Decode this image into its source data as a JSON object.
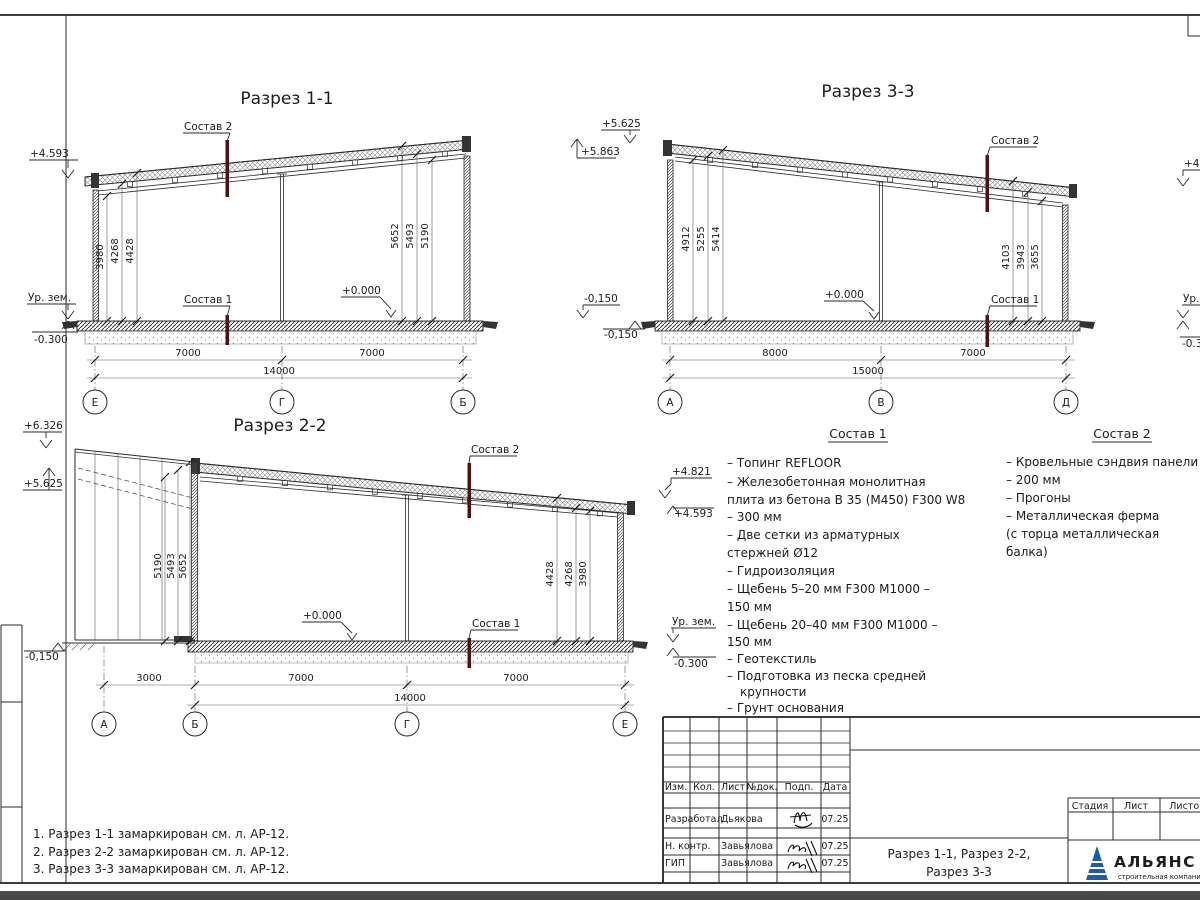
{
  "sheet": {
    "notes": [
      "1. Разрез 1-1 замаркирован см. л. АР-12.",
      "2. Разрез 2-2 замаркирован см. л. АР-12.",
      "3. Разрез 3-3 замаркирован см. л. АР-12."
    ]
  },
  "sections": {
    "s11": {
      "title": "Разрез 1-1",
      "sostav2_label": "Состав 2",
      "sostav1_label": "Состав 1",
      "elev_left_top": "+4.593",
      "ground_label": "Ур. зем.",
      "elev_left_bottom": "-0.300",
      "elev_right_top": "+5.863",
      "elev_right_bottom": "-0,150",
      "floor_mark": "+0.000",
      "dims_left": [
        "3980",
        "4268",
        "4428"
      ],
      "dims_right": [
        "5652",
        "5493",
        "5190"
      ],
      "span_dims": [
        "7000",
        "7000"
      ],
      "total_dim": "14000",
      "axes": [
        "Е",
        "Г",
        "Б"
      ]
    },
    "s33": {
      "title": "Разрез 3-3",
      "sostav2_label": "Состав 2",
      "sostav1_label": "Состав 1",
      "elev_left_top": "+5.625",
      "elev_left_bottom": "-0,150",
      "elev_right_top": "+4.29",
      "ground_label": "Ур. зем.",
      "elev_right_bottom": "-0.300",
      "floor_mark": "+0.000",
      "dims_left": [
        "4912",
        "5255",
        "5414"
      ],
      "dims_right": [
        "4103",
        "3943",
        "3655"
      ],
      "span_dims": [
        "8000",
        "7000"
      ],
      "total_dim": "15000",
      "axes": [
        "А",
        "В",
        "Д"
      ]
    },
    "s22": {
      "title": "Разрез 2-2",
      "sostav2_label": "Состав 2",
      "sostav1_label": "Состав 1",
      "elev_left_top": "+6.326",
      "elev_left_mid": "+5.625",
      "elev_left_bottom": "-0,150",
      "elev_right_top": "+4.821",
      "elev_right_mid": "+4.593",
      "ground_label": "Ур. зем.",
      "elev_right_bottom": "-0.300",
      "floor_mark": "+0.000",
      "dims_left": [
        "5190",
        "5493",
        "5652"
      ],
      "dims_right": [
        "4428",
        "4268",
        "3980"
      ],
      "span_dims": [
        "3000",
        "7000",
        "7000"
      ],
      "total_dim": "14000",
      "axes": [
        "А",
        "Б",
        "Г",
        "Е"
      ]
    }
  },
  "sostav1": {
    "title": "Состав 1",
    "items": [
      "– Топинг REFLOOR",
      "– Железобетонная  монолитная",
      "плита из бетона В 35 (М450) F300 W8",
      "– 300 мм",
      "– Две сетки из арматурных",
      "стержней Ø12",
      "– Гидроизоляция",
      "– Щебень 5–20 мм F300 М1000    –",
      "150 мм",
      "– Щебень 20–40 мм F300 М1000   –",
      "150 мм",
      "– Геотекстиль",
      "– Подготовка из песка средней",
      "крупности",
      "– Грунт основания"
    ]
  },
  "sostav2": {
    "title": "Состав 2",
    "items": [
      "– Кровельные сэндвия панели",
      "– 200 мм",
      "– Прогоны",
      "– Металлическая ферма",
      "(с торца металлическая",
      "балка)"
    ]
  },
  "titleblock": {
    "header_cols": [
      "Изм.",
      "Кол.",
      "Лист",
      "№док.",
      "Подп.",
      "Дата"
    ],
    "rows": [
      {
        "role": "Разработал",
        "name": "Дьякова",
        "date": "07.25"
      },
      {
        "role": "Н. контр.",
        "name": "Завьялова",
        "date": "07.25"
      },
      {
        "role": "ГИП",
        "name": "Завьялова",
        "date": "07.25"
      }
    ],
    "doc_title_line1": "Разрез 1-1, Разрез 2-2,",
    "doc_title_line2": "Разрез 3-3",
    "stage_cols": [
      "Стадия",
      "Лист",
      "Листов"
    ],
    "logo": {
      "name": "АЛЬЯНС",
      "subtitle": "строительная компания",
      "triangle_color": "#1d5aa9",
      "name_color": "#27348b",
      "subtitle_color": "#5b8ed0"
    },
    "marker_color": "#4f1210"
  }
}
